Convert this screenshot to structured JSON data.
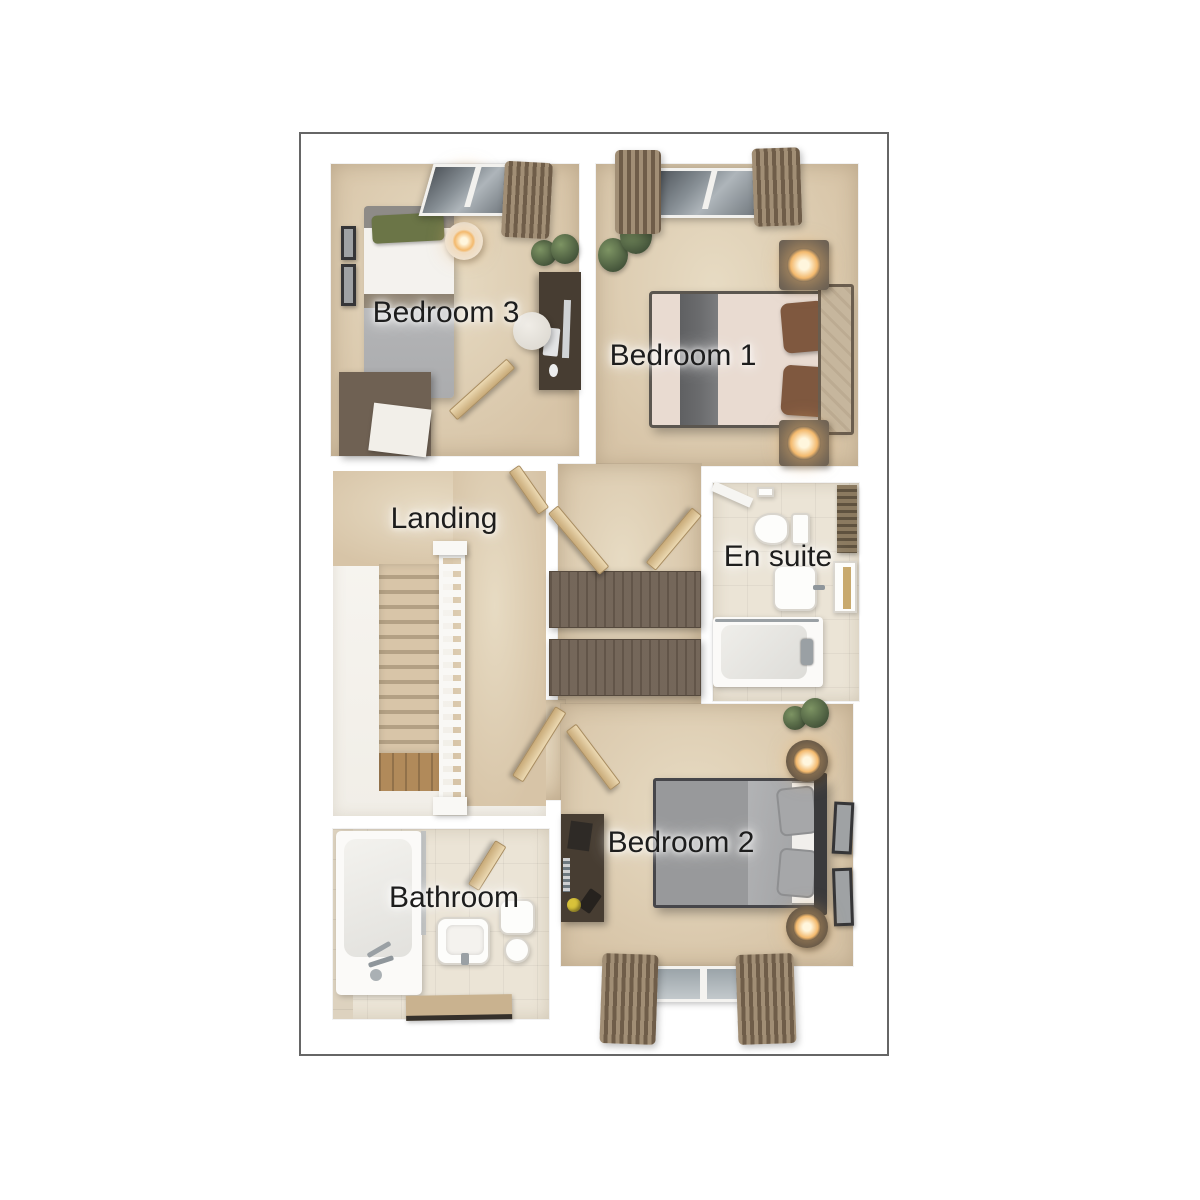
{
  "floorplan": {
    "view": "3D top-down floor plan, first floor",
    "rooms": [
      {
        "id": "bedroom-3",
        "label": "Bedroom 3",
        "furniture": [
          "single bed with green pillow",
          "dresser",
          "desk with monitor",
          "stool",
          "bedside table with lamp",
          "potted plant",
          "two wall pictures",
          "skylight window with curtain",
          "door"
        ]
      },
      {
        "id": "bedroom-1",
        "label": "Bedroom 1",
        "furniture": [
          "double bed with grey runner and brown pillows",
          "upholstered headboard",
          "two nightstands with glowing lamps",
          "potted plants",
          "window with curtains",
          "door"
        ]
      },
      {
        "id": "landing",
        "label": "Landing",
        "furniture": [
          "staircase going down",
          "white banister",
          "doors"
        ]
      },
      {
        "id": "en-suite",
        "label": "En suite",
        "furniture": [
          "toilet",
          "basin",
          "vanity unit",
          "bath with shower rail",
          "door"
        ]
      },
      {
        "id": "bathroom",
        "label": "Bathroom",
        "furniture": [
          "bath with taps",
          "shower screen",
          "basin",
          "toilet",
          "bath mat",
          "door"
        ]
      },
      {
        "id": "bedroom-2",
        "label": "Bedroom 2",
        "furniture": [
          "double bed with grey bedding",
          "two round nightstands with glowing lamps",
          "desk with equipment",
          "two wall pictures",
          "potted plant",
          "window with curtains",
          "door"
        ]
      }
    ],
    "hallway_furniture": [
      "built-in wardrobe",
      "built-in wardrobe"
    ],
    "colors": {
      "frame_border": "#666666",
      "wall": "#f8f6f2",
      "carpet": "#d7c4a7",
      "carpet_light": "#e7dbc3",
      "tile": "#ebe4d6",
      "tile_dark": "#ddd2bf",
      "wood_dark": "#6f6153",
      "wood_desk": "#473d32",
      "door_wood": "#c9ab79",
      "curtain_light": "#a18e75",
      "curtain_dark": "#6f5d49",
      "glass_dark": "#51575d",
      "glass_light": "#aeb5ba",
      "plant_light": "#7d9463",
      "plant_dark": "#44543a",
      "lamp_core": "#fff6dd",
      "lamp_glow": "#f3b96d",
      "bed1_duvet": "#e9dbd1",
      "bed1_runner": "#6a6b6d",
      "bed1_pillow": "#7f583f",
      "bed1_headboard": "#c6b69d",
      "bed2_duvet": "#98999b",
      "bed2_fold": "#b2b3b5",
      "bed2_mattress": "#f1efec",
      "bed2_pillow": "#a6a7a9",
      "bed2_headboard": "#3a3a3c",
      "bed3_blanket": "#abacae",
      "bed3_sheet": "#f4f2ee",
      "bed3_pillow": "#6b7547",
      "bed3_headboard": "#8e8b87",
      "stair_step": "#d8c5a8",
      "stair_shadow": "#b3a084",
      "stair_wood": "#b18a5a",
      "banister": "#f9f8f5",
      "rug": "#c9b28f",
      "rug_edge": "#35302a",
      "label_text": "#1d1d1d"
    }
  }
}
